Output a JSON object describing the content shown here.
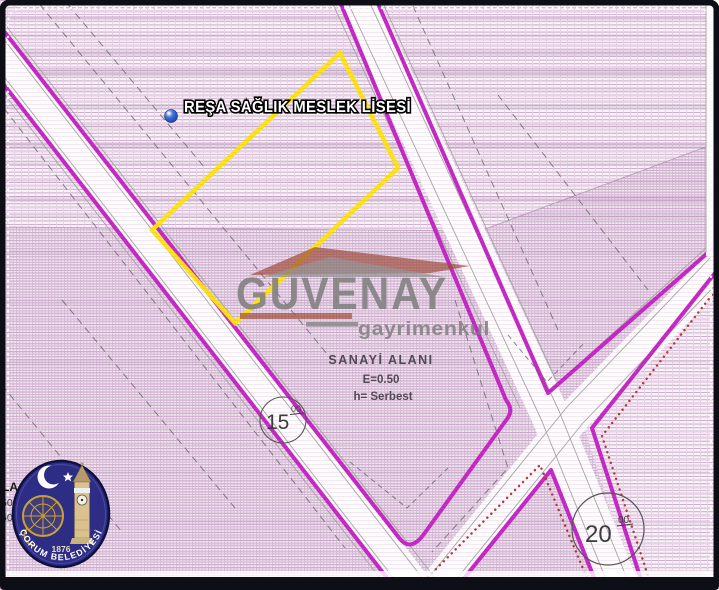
{
  "map": {
    "school_label": "REŞA SAĞLIK MESLEK LİSESİ",
    "zone_label": {
      "name": "SANAYİ ALANI",
      "emsal": "E=0.50",
      "height": "h= Serbest"
    },
    "road_labels": {
      "road_15": {
        "value": "15",
        "decimals": "00"
      },
      "road_20": {
        "value": "20",
        "decimals": "00"
      }
    },
    "edge_fragments": [
      "LA",
      "50",
      "60"
    ]
  },
  "watermark": {
    "brand": "GUVENAY",
    "subtitle": "gayrimenkul"
  },
  "municipality_logo": {
    "name": "ÇORUM BELEDİYESİ",
    "year": "1876"
  },
  "colors": {
    "road_border_magenta": "#c625c6",
    "parcel_highlight_yellow": "#ffe600",
    "planned_road_dots_red": "#b83434",
    "hatch_light_line": "#d4b8d4",
    "hatch_dense_line": "#c4a2c4",
    "watermark_gray": "#7d7d7d",
    "watermark_brick": "#9c4a38",
    "logo_navy": "#2d2d86"
  }
}
